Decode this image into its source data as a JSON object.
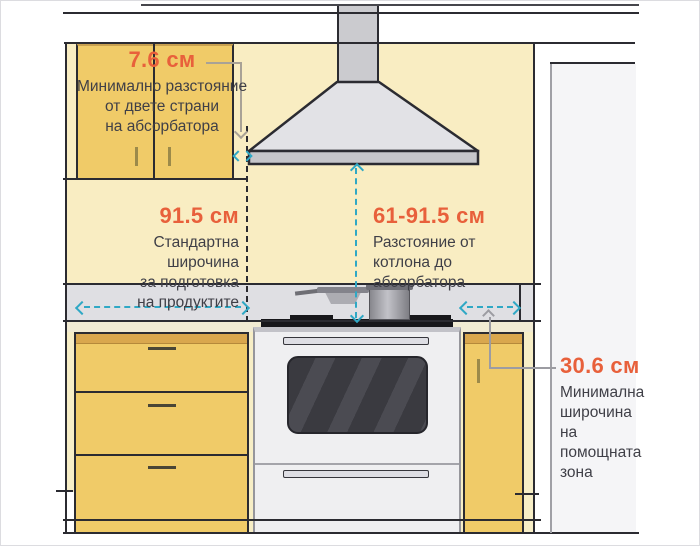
{
  "measurements": {
    "hood_side": {
      "value": "7.6 см",
      "desc": [
        "Минимално разстояние",
        "от двете страни",
        "на абсорбатора"
      ]
    },
    "prep_width": {
      "value": "91.5 см",
      "desc": [
        "Стандартна широчина",
        "за подготовка",
        "на продуктите"
      ]
    },
    "hood_height": {
      "value": "61-91.5 см",
      "desc": [
        "Разстояние от",
        "котлона до",
        "абсорбатора"
      ]
    },
    "aux_zone": {
      "value": "30.6 см",
      "desc": [
        "Минимална",
        "широчина",
        "на",
        "помощната",
        "зона"
      ]
    }
  },
  "colors": {
    "accent_orange": "#E8603B",
    "dimension_blue": "#2FA8C5",
    "wall_yellow": "#F9EDC2",
    "cabinet_gold": "#F0CB68",
    "cabinet_band": "#D9A74E",
    "hood_gray": "#E2E2E6",
    "text_dark": "#3F3F47"
  }
}
